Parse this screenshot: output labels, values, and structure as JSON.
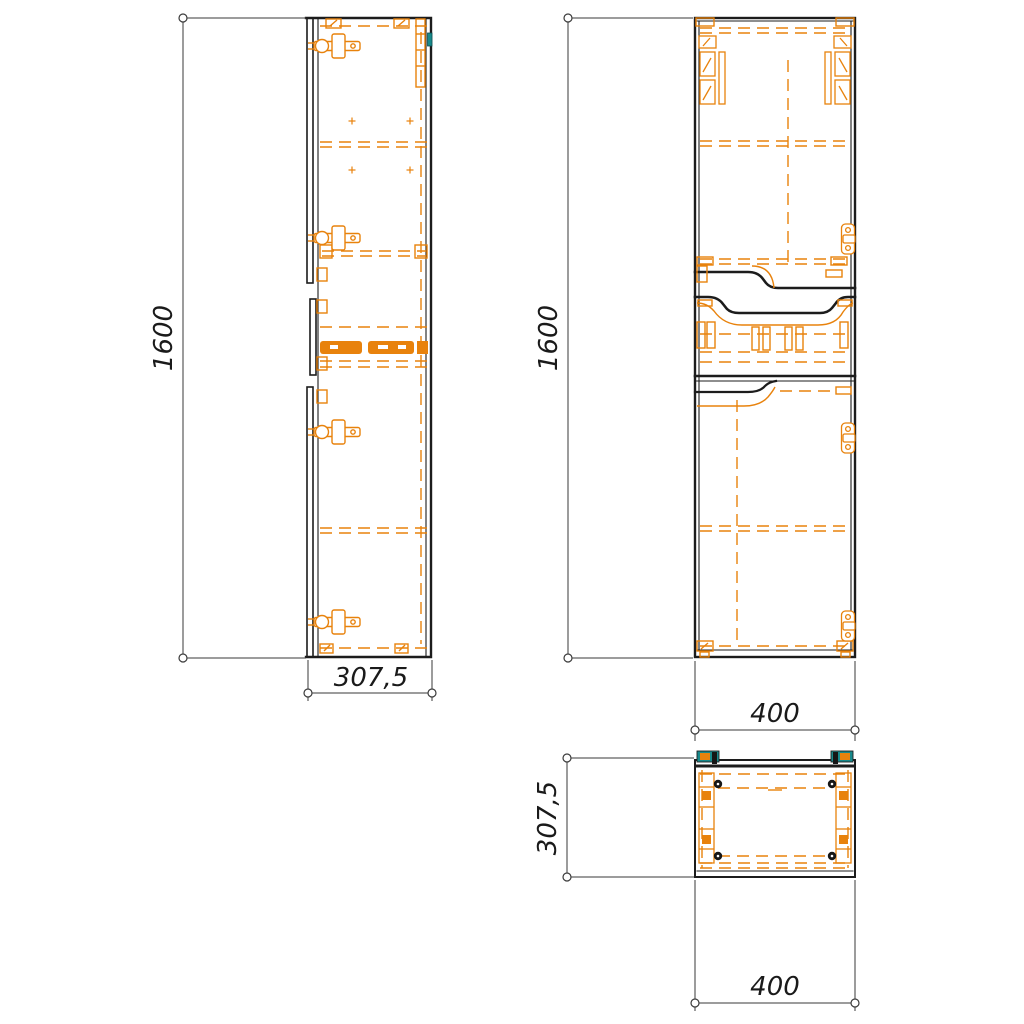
{
  "drawing": {
    "type": "furniture-cabinet-technical-drawing",
    "dimensions": {
      "side_height": "1600",
      "side_depth": "307,5",
      "front_height": "1600",
      "front_width": "400",
      "top_depth": "307,5",
      "top_width": "400"
    },
    "colors": {
      "outline": "#1c1c1c",
      "hidden_detail": "#e8820c",
      "mount_bracket": "#18898b",
      "dimension_lines": "#3a3a3a",
      "background": "#ffffff"
    }
  }
}
